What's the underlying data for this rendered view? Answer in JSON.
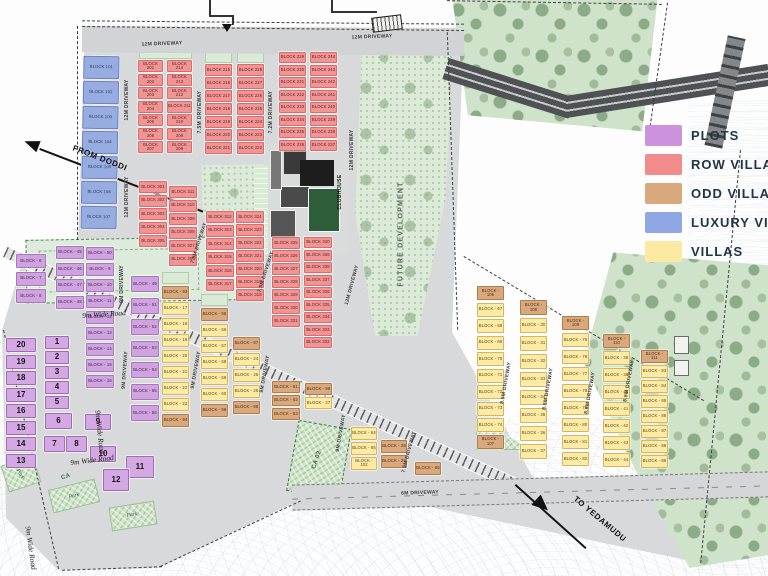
{
  "legend": {
    "items": [
      {
        "label": "PLOTS",
        "color": "#cd92dc"
      },
      {
        "label": "ROW VILLAS",
        "color": "#f28b8b"
      },
      {
        "label": "ODD VILLAS",
        "color": "#d8a97c"
      },
      {
        "label": "LUXURY VILLAS",
        "color": "#8fa7e3"
      },
      {
        "label": "VILLAS",
        "color": "#fce9a2"
      }
    ]
  },
  "map_labels": [
    {
      "id": "r1",
      "text": "12M DRIVEWAY",
      "cls": "road"
    },
    {
      "id": "r2",
      "text": "12M DRIVEWAY",
      "cls": "road"
    },
    {
      "id": "r3",
      "text": "12M DRIVEWAY",
      "cls": "road"
    },
    {
      "id": "r4",
      "text": "12M DRIVEWAY",
      "cls": "road"
    },
    {
      "id": "r5",
      "text": "12M DRIVEWAY",
      "cls": "road"
    },
    {
      "id": "r6",
      "text": "12M DRIVEWAY",
      "cls": "road"
    },
    {
      "id": "r7",
      "text": "7.5M DRIVEWAY",
      "cls": "road"
    },
    {
      "id": "r8",
      "text": "7.2M DRIVEWAY",
      "cls": "road"
    },
    {
      "id": "r9",
      "text": "7.5M DRIVEWAY",
      "cls": "road"
    },
    {
      "id": "r10",
      "text": "7.5M DRIVEWAY",
      "cls": "road"
    },
    {
      "id": "r11",
      "text": "7.5M DRIVEWAY",
      "cls": "road"
    },
    {
      "id": "r12",
      "text": "9M DRIVEWAY",
      "cls": "road"
    },
    {
      "id": "r13",
      "text": "9M DRIVEWAY",
      "cls": "road"
    },
    {
      "id": "r14",
      "text": "9M DRIVEWAY",
      "cls": "road"
    },
    {
      "id": "r15",
      "text": "9M DRIVEWAY",
      "cls": "road"
    },
    {
      "id": "r16",
      "text": "9M DRIVEWAY",
      "cls": "road"
    },
    {
      "id": "r17",
      "text": "8.5M DRIVEWAY",
      "cls": "road"
    },
    {
      "id": "r18",
      "text": "8.5M DRIVEWAY",
      "cls": "road"
    },
    {
      "id": "r19",
      "text": "8.5M DRIVEWAY",
      "cls": "road"
    },
    {
      "id": "r20",
      "text": "8.5M DRIVEWAY",
      "cls": "road"
    },
    {
      "id": "r21",
      "text": "6M DRIVEWAY",
      "cls": "road"
    },
    {
      "id": "w1",
      "text": "9m Wide Road",
      "cls": "wroad"
    },
    {
      "id": "w2",
      "text": "9m Wide Road",
      "cls": "wroad"
    },
    {
      "id": "w3",
      "text": "9m Wide Road",
      "cls": "wroad"
    },
    {
      "id": "w4",
      "text": "9m Wide Road",
      "cls": "wroad"
    },
    {
      "id": "a1",
      "text": "FUTURE DEVELOPMENT",
      "cls": "area"
    },
    {
      "id": "a2",
      "text": "CLUBHOUSE",
      "cls": "club"
    },
    {
      "id": "a3",
      "text": "CA 02",
      "cls": "area-sm"
    },
    {
      "id": "a4",
      "text": "CA",
      "cls": "area-sm"
    },
    {
      "id": "p1",
      "text": "Park",
      "cls": "park-lbl"
    },
    {
      "id": "p2",
      "text": "Park",
      "cls": "park-lbl"
    },
    {
      "id": "p3",
      "text": "Park",
      "cls": "park-lbl"
    },
    {
      "id": "d1",
      "text": "FROM DODDI",
      "cls": "dir"
    },
    {
      "id": "d2",
      "text": "TO YEDAMUDU",
      "cls": "dir"
    }
  ],
  "block_groups": [
    {
      "id": "cL",
      "type": "luxury",
      "labels": [
        "BLOCK 101",
        "BLOCK 102",
        "BLOCK 103",
        "BLOCK 104",
        "BLOCK 105",
        "BLOCK 106",
        "BLOCK 107"
      ]
    },
    {
      "id": "c201",
      "type": "row",
      "labels": [
        "BLOCK 201",
        "BLOCK 202",
        "BLOCK 203",
        "BLOCK 204",
        "BLOCK 205",
        "BLOCK 206",
        "BLOCK 207"
      ]
    },
    {
      "id": "c214",
      "type": "row",
      "labels": [
        "BLOCK 214",
        "BLOCK 213",
        "BLOCK 212",
        "BLOCK 211",
        "BLOCK 210",
        "BLOCK 209",
        "BLOCK 208"
      ]
    },
    {
      "id": "c215",
      "type": "row",
      "labels": [
        "BLOCK 215",
        "BLOCK 216",
        "BLOCK 217",
        "BLOCK 218",
        "BLOCK 219",
        "BLOCK 220",
        "BLOCK 221"
      ]
    },
    {
      "id": "c228",
      "type": "row",
      "labels": [
        "BLOCK 228",
        "BLOCK 227",
        "BLOCK 226",
        "BLOCK 225",
        "BLOCK 224",
        "BLOCK 223",
        "BLOCK 222"
      ]
    },
    {
      "id": "c229",
      "type": "row",
      "labels": [
        "BLOCK 229",
        "BLOCK 230",
        "BLOCK 231",
        "BLOCK 232",
        "BLOCK 233",
        "BLOCK 234",
        "BLOCK 235",
        "BLOCK 236"
      ]
    },
    {
      "id": "c244",
      "type": "row",
      "labels": [
        "BLOCK 244",
        "BLOCK 243",
        "BLOCK 242",
        "BLOCK 241",
        "BLOCK 240",
        "BLOCK 239",
        "BLOCK 238",
        "BLOCK 237"
      ]
    },
    {
      "id": "c301",
      "type": "row",
      "labels": [
        "BLOCK 301",
        "BLOCK 302",
        "BLOCK 303",
        "BLOCK 304",
        "BLOCK 305"
      ]
    },
    {
      "id": "c311",
      "type": "row",
      "labels": [
        "BLOCK 311",
        "BLOCK 310",
        "BLOCK 309",
        "BLOCK 308",
        "BLOCK 307",
        "BLOCK 306"
      ]
    },
    {
      "id": "c312",
      "type": "row",
      "labels": [
        "BLOCK 312",
        "BLOCK 313",
        "BLOCK 314",
        "BLOCK 315",
        "BLOCK 316",
        "BLOCK 317"
      ]
    },
    {
      "id": "c324",
      "type": "row",
      "labels": [
        "BLOCK 324",
        "BLOCK 323",
        "BLOCK 322",
        "BLOCK 321",
        "BLOCK 320",
        "BLOCK 319",
        "BLOCK 318"
      ]
    },
    {
      "id": "c325",
      "type": "row",
      "labels": [
        "BLOCK 325",
        "BLOCK 326",
        "BLOCK 327",
        "BLOCK 328",
        "BLOCK 329",
        "BLOCK 330",
        "BLOCK 331"
      ]
    },
    {
      "id": "c340",
      "type": "row",
      "labels": [
        "BLOCK 340",
        "BLOCK 339",
        "BLOCK 338",
        "BLOCK 337",
        "BLOCK 336",
        "BLOCK 335",
        "BLOCK 334",
        "BLOCK 333",
        "BLOCK 332"
      ]
    },
    {
      "id": "cP6",
      "type": "plots",
      "labels": [
        "BLOCK - 6",
        "BLOCK - 7",
        "BLOCK - 8"
      ]
    },
    {
      "id": "cP45",
      "type": "plots",
      "labels": [
        "BLOCK - 45",
        "BLOCK - 46",
        "BLOCK - 47",
        "BLOCK - 48"
      ]
    },
    {
      "id": "cP9",
      "type": "plots",
      "labels": [
        "BLOCK - 50",
        "BLOCK - 9",
        "BLOCK - 10",
        "BLOCK - 11",
        "BLOCK - 12",
        "BLOCK - 13",
        "BLOCK - 14",
        "BLOCK - 15",
        "BLOCK - 16"
      ]
    },
    {
      "id": "cP49",
      "type": "plots",
      "labels": [
        "BLOCK - 49",
        "BLOCK - 51",
        "BLOCK - 52",
        "BLOCK - 53",
        "BLOCK - 54",
        "BLOCK - 55",
        "BLOCK - 56"
      ]
    },
    {
      "id": "colL",
      "type": "plotnum",
      "labels": [
        "20",
        "19",
        "18",
        "17",
        "16",
        "15",
        "14",
        "13"
      ]
    },
    {
      "id": "colM1",
      "type": "plotnum",
      "labels": [
        "1",
        "2",
        "3",
        "4",
        "5"
      ]
    },
    {
      "id": "gridP",
      "type": "plotnum",
      "labels": [
        "6",
        "9",
        "7",
        "8",
        "10",
        "11",
        "12"
      ]
    },
    {
      "id": "cY17",
      "type": "villa",
      "labels": [
        "BLOCK - 93",
        "BLOCK - 17",
        "BLOCK - 18",
        "BLOCK - 19",
        "BLOCK - 20",
        "BLOCK - 21",
        "BLOCK - 22",
        "BLOCK - 23",
        "BLOCK - 94"
      ],
      "types": [
        "odd",
        "villa",
        "villa",
        "villa",
        "villa",
        "villa",
        "villa",
        "villa",
        "odd"
      ]
    },
    {
      "id": "cY56",
      "type": "villa",
      "labels": [
        "BLOCK - 95",
        "BLOCK - 56",
        "BLOCK - 57",
        "BLOCK - 58",
        "BLOCK - 59",
        "BLOCK - 60",
        "BLOCK - 96"
      ],
      "types": [
        "odd",
        "villa",
        "villa",
        "villa",
        "villa",
        "villa",
        "odd"
      ]
    },
    {
      "id": "cT24",
      "type": "villa",
      "labels": [
        "BLOCK - 97",
        "BLOCK - 24",
        "BLOCK - 25",
        "BLOCK - 26",
        "BLOCK - 98"
      ],
      "types": [
        "odd",
        "villa",
        "villa",
        "villa",
        "odd"
      ]
    },
    {
      "id": "colE",
      "type": "odd",
      "labels": [
        "BLOCK - 61",
        "BLOCK - 62",
        "BLOCK - 63"
      ]
    },
    {
      "id": "colF",
      "type": "villa",
      "labels": [
        "BLOCK - 99",
        "BLOCK - 27"
      ],
      "types": [
        "odd",
        "villa"
      ]
    },
    {
      "id": "colG",
      "type": "villa",
      "labels": [
        "BLOCK - 64",
        "BLOCK - 65",
        "BLOCK - 102"
      ]
    },
    {
      "id": "colH",
      "type": "odd",
      "labels": [
        "BLOCK - 28",
        "BLOCK - 29"
      ]
    },
    {
      "id": "colI",
      "type": "odd",
      "labels": [
        "BLOCK - 66"
      ]
    },
    {
      "id": "cR1",
      "type": "villa",
      "labels": [
        "BLOCK - 106",
        "BLOCK - 67",
        "BLOCK - 68",
        "BLOCK - 69",
        "BLOCK - 70",
        "BLOCK - 71",
        "BLOCK - 72",
        "BLOCK - 73",
        "BLOCK - 74",
        "BLOCK - 107"
      ],
      "types": [
        "odd",
        "villa",
        "villa",
        "villa",
        "villa",
        "villa",
        "villa",
        "villa",
        "villa",
        "odd"
      ]
    },
    {
      "id": "cR2",
      "type": "villa",
      "labels": [
        "BLOCK - 108",
        "BLOCK - 30",
        "BLOCK - 31",
        "BLOCK - 32",
        "BLOCK - 33",
        "BLOCK - 34",
        "BLOCK - 35",
        "BLOCK - 36",
        "BLOCK - 37"
      ],
      "types": [
        "odd",
        "villa",
        "villa",
        "villa",
        "villa",
        "villa",
        "villa",
        "villa",
        "villa"
      ]
    },
    {
      "id": "cR3",
      "type": "villa",
      "labels": [
        "BLOCK - 109",
        "BLOCK - 75",
        "BLOCK - 76",
        "BLOCK - 77",
        "BLOCK - 78",
        "BLOCK - 79",
        "BLOCK - 80",
        "BLOCK - 81",
        "BLOCK - 82"
      ],
      "types": [
        "odd",
        "villa",
        "villa",
        "villa",
        "villa",
        "villa",
        "villa",
        "villa",
        "villa"
      ]
    },
    {
      "id": "cR4",
      "type": "villa",
      "labels": [
        "BLOCK - 110",
        "BLOCK - 38",
        "BLOCK - 39",
        "BLOCK - 40",
        "BLOCK - 41",
        "BLOCK - 42",
        "BLOCK - 43",
        "BLOCK - 44"
      ],
      "types": [
        "odd",
        "villa",
        "villa",
        "villa",
        "villa",
        "villa",
        "villa",
        "villa"
      ]
    },
    {
      "id": "cR5",
      "type": "villa",
      "labels": [
        "BLOCK - 111",
        "BLOCK - 83",
        "BLOCK - 84",
        "BLOCK - 85",
        "BLOCK - 86",
        "BLOCK - 87",
        "BLOCK - 88",
        "BLOCK - 89"
      ],
      "types": [
        "odd",
        "villa",
        "villa",
        "villa",
        "villa",
        "villa",
        "villa",
        "villa"
      ]
    }
  ]
}
